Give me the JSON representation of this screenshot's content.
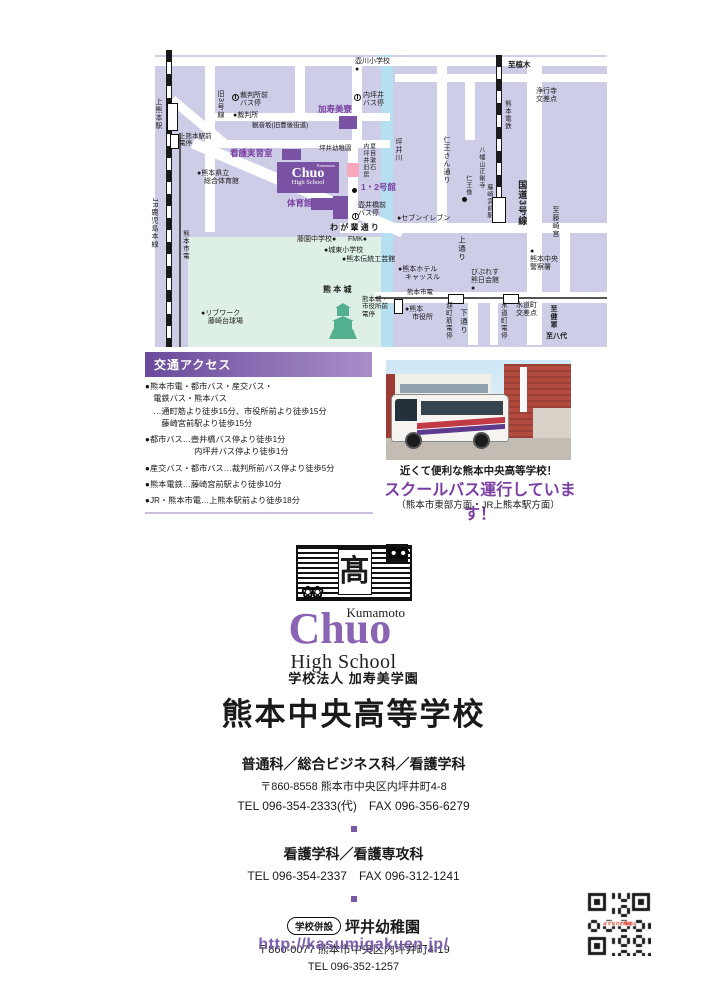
{
  "colors": {
    "brand_purple": "#7a57a8",
    "map_block": "#cdcde8",
    "river_blue": "#b5e0f2",
    "castle_green": "#def0e6",
    "building_purple": "#7a52a3",
    "kindergarten_pink": "#f7a8bc"
  },
  "map": {
    "school_box": {
      "l1": "Kumamoto",
      "l2": "Chuo",
      "l3": "High School"
    },
    "labels": [
      {
        "t": "壺川小学校\n●",
        "x": 210,
        "y": 10,
        "s": 7
      },
      {
        "t": "至植木",
        "x": 363,
        "y": 13,
        "s": 7.5,
        "b": 1
      },
      {
        "t": "浄行寺\n交差点",
        "x": 391,
        "y": 40,
        "s": 7
      },
      {
        "t": "熊本電鉄",
        "x": 358,
        "y": 52,
        "s": 6.5,
        "v": 1
      },
      {
        "t": "旧3号線",
        "x": 71,
        "y": 42,
        "s": 7,
        "v": 1
      },
      {
        "t": "裁判所前\nバス停",
        "x": 95,
        "y": 44,
        "s": 7
      },
      {
        "t": "●裁判所",
        "x": 88,
        "y": 64,
        "s": 7
      },
      {
        "t": "観音坂(旧豊後街道)",
        "x": 107,
        "y": 74,
        "s": 6.5
      },
      {
        "t": "加寿美寮",
        "x": 173,
        "y": 57,
        "s": 8.5,
        "c": "pu"
      },
      {
        "t": "内坪井\nバス停",
        "x": 218,
        "y": 44,
        "s": 7
      },
      {
        "t": "看護実習室",
        "x": 85,
        "y": 101,
        "s": 8.5,
        "c": "pu"
      },
      {
        "t": "坪井幼稚園",
        "x": 174,
        "y": 97,
        "s": 6.5
      },
      {
        "t": "夏目漱石\n内坪井旧居",
        "x": 216,
        "y": 95,
        "s": 6,
        "v": 1
      },
      {
        "t": "1・2号館",
        "x": 216,
        "y": 135,
        "s": 8.5,
        "c": "pu"
      },
      {
        "t": "体育館",
        "x": 142,
        "y": 151,
        "s": 8.5,
        "c": "pu"
      },
      {
        "t": "壺井橋前\nバス停",
        "x": 213,
        "y": 154,
        "s": 7
      },
      {
        "t": "●セブンイレブン",
        "x": 252,
        "y": 167,
        "s": 7
      },
      {
        "t": "わ が 輩 通 り",
        "x": 185,
        "y": 175,
        "s": 8,
        "b": 1
      },
      {
        "t": "藤園中学校●",
        "x": 152,
        "y": 188,
        "s": 7
      },
      {
        "t": "FMK●",
        "x": 203,
        "y": 188,
        "s": 7
      },
      {
        "t": "●城東小学校",
        "x": 179,
        "y": 199,
        "s": 7
      },
      {
        "t": "●熊本伝統工芸館",
        "x": 197,
        "y": 208,
        "s": 7
      },
      {
        "t": "坪井川",
        "x": 249,
        "y": 90,
        "s": 7,
        "v": 1
      },
      {
        "t": "仁王さん通り",
        "x": 297,
        "y": 88,
        "s": 7,
        "v": 1
      },
      {
        "t": "八幡山正剛寺",
        "x": 332,
        "y": 99,
        "s": 6,
        "v": 1
      },
      {
        "t": "仁王像",
        "x": 319,
        "y": 127,
        "s": 6,
        "v": 1
      },
      {
        "t": "藤崎宮前駅",
        "x": 340,
        "y": 136,
        "s": 6,
        "v": 1
      },
      {
        "t": "国道3号線",
        "x": 372,
        "y": 132,
        "s": 9,
        "v": 1,
        "b": 1
      },
      {
        "t": "至藤崎宮",
        "x": 406,
        "y": 158,
        "s": 7,
        "v": 1
      },
      {
        "t": "●\n熊本中央\n警察署",
        "x": 385,
        "y": 200,
        "s": 7
      },
      {
        "t": "上通り",
        "x": 312,
        "y": 188,
        "s": 7.5,
        "v": 1
      },
      {
        "t": "●熊本ホテル\n　キャッスル",
        "x": 253,
        "y": 218,
        "s": 7
      },
      {
        "t": "びぷれす\n熊日会館\n●",
        "x": 326,
        "y": 221,
        "s": 7
      },
      {
        "t": "熊本市電",
        "x": 262,
        "y": 241,
        "s": 6.5
      },
      {
        "t": "●熊本\n　市役所",
        "x": 260,
        "y": 258,
        "s": 7
      },
      {
        "t": "通町筋電停",
        "x": 299,
        "y": 254,
        "s": 6.5,
        "v": 1
      },
      {
        "t": "下通り",
        "x": 314,
        "y": 261,
        "s": 7.5,
        "v": 1
      },
      {
        "t": "水道町電停",
        "x": 354,
        "y": 254,
        "s": 6.5,
        "v": 1
      },
      {
        "t": "水道町\n交差点",
        "x": 371,
        "y": 254,
        "s": 7
      },
      {
        "t": "至健軍",
        "x": 404,
        "y": 257,
        "s": 7,
        "v": 1,
        "b": 1
      },
      {
        "t": "至八代",
        "x": 401,
        "y": 285,
        "s": 7,
        "b": 1
      },
      {
        "t": "熊 本 城",
        "x": 178,
        "y": 237,
        "s": 8,
        "b": 1
      },
      {
        "t": "熊本城・\n市役所前\n電停",
        "x": 217,
        "y": 248,
        "s": 6.5
      },
      {
        "t": "●リブワーク\n　藤崎台球場",
        "x": 56,
        "y": 262,
        "s": 7
      },
      {
        "t": "上熊本駅",
        "x": 9,
        "y": 50,
        "s": 7,
        "v": 1
      },
      {
        "t": "上熊本駅前\n電停",
        "x": 34,
        "y": 85,
        "s": 6.5
      },
      {
        "t": "●熊本県立\n　総合体育館",
        "x": 52,
        "y": 122,
        "s": 7
      },
      {
        "t": "JR鹿児島本線",
        "x": 5,
        "y": 150,
        "s": 7,
        "v": 1
      },
      {
        "t": "熊本市電",
        "x": 36,
        "y": 182,
        "s": 6.5,
        "v": 1
      }
    ],
    "poles": [
      {
        "x": 87,
        "y": 46
      },
      {
        "x": 209,
        "y": 46
      },
      {
        "x": 207,
        "y": 165
      }
    ],
    "dots": [
      {
        "x": 207,
        "y": 140
      },
      {
        "x": 317,
        "y": 149
      }
    ]
  },
  "access": {
    "title": "交通アクセス",
    "items": [
      "●熊本市電・都市バス・産交バス・\n　電鉄バス・熊本バス\n　…通町筋より徒歩15分、市役所前より徒歩15分\n　　藤崎宮前駅より徒歩15分",
      "●都市バス…壺井橋バス停より徒歩1分\n　　　　　　内坪井バス停より徒歩1分",
      "●産交バス・都市バス…裁判所前バス停より徒歩5分",
      "●熊本電鉄…藤崎宮前駅より徒歩10分",
      "●JR・熊本市電…上熊本駅前より徒歩18分"
    ]
  },
  "bus_section": {
    "caption1": "近くて便利な熊本中央高等学校！",
    "caption2": "スクールバス運行しています！",
    "caption3": "（熊本市東部方面・JR上熊本駅方面）"
  },
  "logo": {
    "emblem_kanji": "髙",
    "flowers": "❀❀",
    "kumamoto": "Kumamoto",
    "chuo": "Chuo",
    "high_school": "High School"
  },
  "school": {
    "corporation": "学校法人 加寿美学園",
    "name": "熊本中央高等学校",
    "departments": "普通科／総合ビジネス科／看護学科",
    "address1": "〒860-8558 熊本市中央区内坪井町4-8",
    "tel_fax1": "TEL 096-354-2333(代)　FAX 096-356-6279",
    "nursing": "看護学科／看護専攻科",
    "tel_fax2": "TEL 096-354-2337　FAX 096-312-1241",
    "annex_label": "学校併設",
    "kindergarten": "坪井幼稚園",
    "address2": "〒860-0077 熊本市中央区内坪井町4-19",
    "tel3": "TEL 096-352-1257",
    "url": "http://kasumigakuen.jp/"
  },
  "qr": {
    "center_label": "キミだけの情報!!"
  }
}
